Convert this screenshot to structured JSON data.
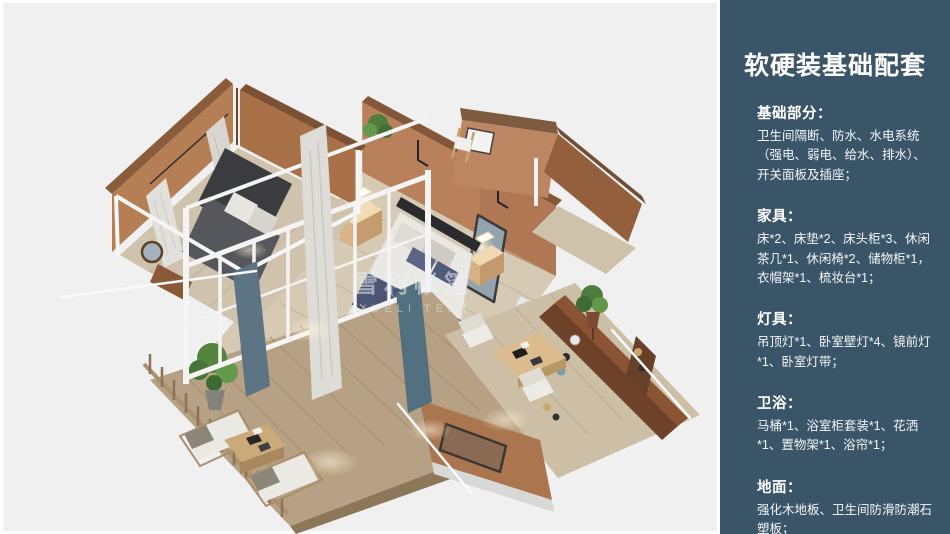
{
  "page": {
    "background": "#ffffff",
    "canvas_bg": "#f0f0f1"
  },
  "floorplan": {
    "watermark_cn": "雪利帐篷",
    "watermark_en": "XUELI TENT"
  },
  "sidebar": {
    "bg_color": "#3b5568",
    "text_color": "#ffffff",
    "title": "软硬装基础配套",
    "sections": [
      {
        "heading": "基础部分：",
        "body": "卫生间隔断、防水、水电系统（强电、弱电、给水、排水）、开关面板及插座；"
      },
      {
        "heading": "家具：",
        "body": "床*2、床垫*2、床头柜*3、休闲茶几*1、休闲椅*2、储物柜*1，衣帽架*1、梳妆台*1；"
      },
      {
        "heading": "灯具：",
        "body": "吊顶灯*1、卧室壁灯*4、镜前灯*1、卧室灯带；"
      },
      {
        "heading": "卫浴：",
        "body": "马桶*1、浴室柜套装*1、花洒*1、置物架*1、浴帘*1；"
      },
      {
        "heading": "地面：",
        "body": "强化木地板、卫生间防滑防潮石塑板；"
      }
    ]
  }
}
